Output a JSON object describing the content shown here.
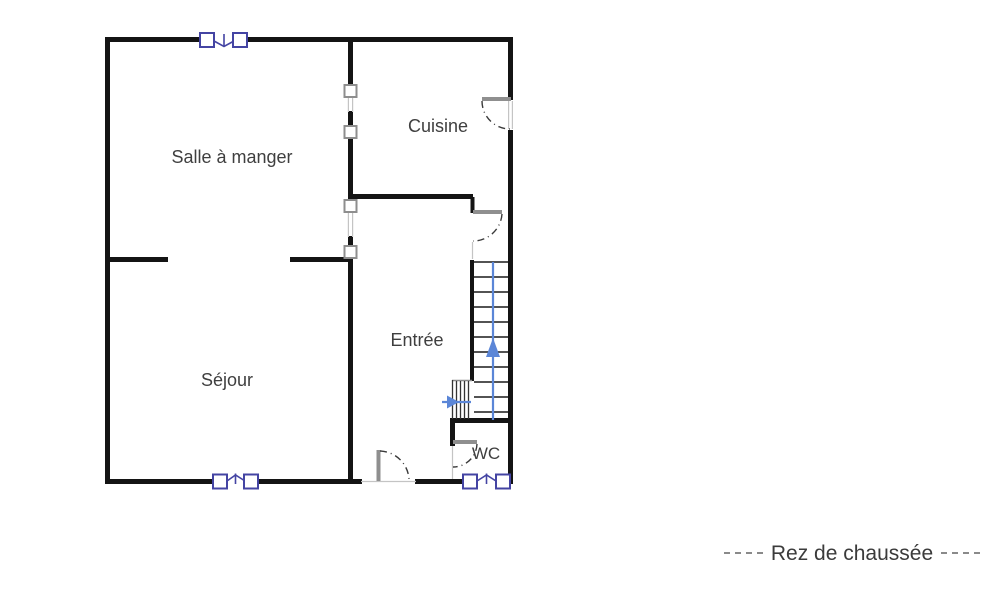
{
  "rooms": {
    "salle_a_manger": {
      "label": "Salle à manger"
    },
    "cuisine": {
      "label": "Cuisine"
    },
    "sejour": {
      "label": "Séjour"
    },
    "entree": {
      "label": "Entrée"
    },
    "wc": {
      "label": "WC"
    }
  },
  "caption": {
    "label": "Rez de chaussée"
  },
  "colors": {
    "wall": "#141414",
    "window_frame": "#4444a3",
    "stair_arrow": "#5b86d7",
    "label_text": "#3f3f3f",
    "caption_text": "#3b3b3b",
    "caption_dash": "#8a8a8a",
    "background": "#ffffff"
  }
}
